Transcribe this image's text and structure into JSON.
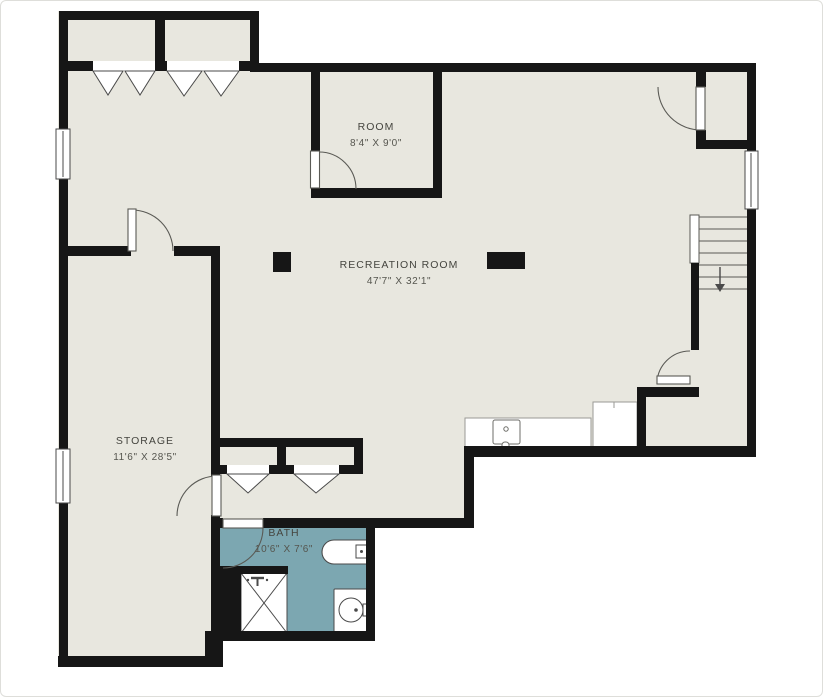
{
  "plan": {
    "type": "basement-floor-plan",
    "stairs_direction": "down"
  },
  "colors": {
    "background": "#ffffff",
    "floor": "#e8e7df",
    "wall": "#161616",
    "bath_floor": "#7ca7b1",
    "fixture_outline": "#4a4a4a",
    "door_line": "#5a5a55",
    "label_text": "#45453f",
    "dim_text": "#55554e"
  },
  "rooms": [
    {
      "id": "room",
      "name": "ROOM",
      "dimensions": "8'4\" X 9'0\""
    },
    {
      "id": "recreation-room",
      "name": "RECREATION ROOM",
      "dimensions": "47'7\" X 32'1\""
    },
    {
      "id": "storage",
      "name": "STORAGE",
      "dimensions": "11'6\" X 28'5\""
    },
    {
      "id": "bath",
      "name": "BATH",
      "dimensions": "10'6\" X 7'6\""
    }
  ],
  "fixtures": [
    "bathtub",
    "shower-stall",
    "toilet",
    "bathroom-door",
    "kitchen-counter",
    "counter-sink",
    "appliance-cabinet",
    "staircase-down",
    "support-column",
    "support-column-wide",
    "bifold-closet-doors",
    "windows",
    "swing-doors"
  ]
}
